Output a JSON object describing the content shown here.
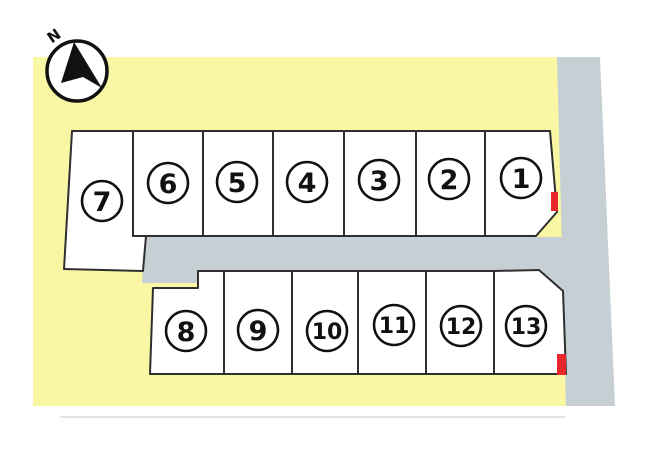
{
  "plan": {
    "name": "residential lot layout site plan",
    "compass": {
      "label": "N"
    },
    "rows": {
      "top_count": 7,
      "bottom_count": 6
    },
    "lots": [
      {
        "number": "1",
        "row": "top",
        "red_marker": true
      },
      {
        "number": "2",
        "row": "top",
        "red_marker": false
      },
      {
        "number": "3",
        "row": "top",
        "red_marker": false
      },
      {
        "number": "4",
        "row": "top",
        "red_marker": false
      },
      {
        "number": "5",
        "row": "top",
        "red_marker": false
      },
      {
        "number": "6",
        "row": "top",
        "red_marker": false
      },
      {
        "number": "7",
        "row": "top",
        "red_marker": false
      },
      {
        "number": "8",
        "row": "bottom",
        "red_marker": false
      },
      {
        "number": "9",
        "row": "bottom",
        "red_marker": false
      },
      {
        "number": "10",
        "row": "bottom",
        "red_marker": false
      },
      {
        "number": "11",
        "row": "bottom",
        "red_marker": false
      },
      {
        "number": "12",
        "row": "bottom",
        "red_marker": false
      },
      {
        "number": "13",
        "row": "bottom",
        "red_marker": true
      }
    ]
  },
  "colors": {
    "land": "#f9f7a4",
    "road": "#c6cfd3",
    "parcel-fill": "#ffffff",
    "parcel-border": "#2f2f2f",
    "marker-red": "#e8262c",
    "ink": "#111111"
  }
}
